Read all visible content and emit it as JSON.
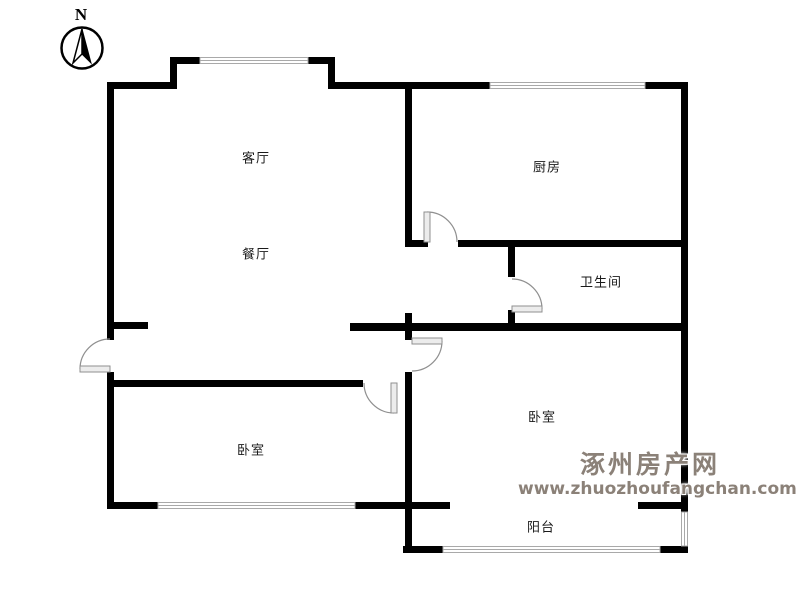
{
  "compass": {
    "label": "N",
    "icon": "north-compass-icon"
  },
  "rooms": [
    {
      "id": "living-room",
      "label": "客厅"
    },
    {
      "id": "dining-room",
      "label": "餐厅"
    },
    {
      "id": "kitchen",
      "label": "厨房"
    },
    {
      "id": "bathroom",
      "label": "卫生间"
    },
    {
      "id": "bedroom-right",
      "label": "卧室"
    },
    {
      "id": "bedroom-left",
      "label": "卧室"
    },
    {
      "id": "balcony",
      "label": "阳台"
    }
  ],
  "watermark": {
    "site_name": "涿州房产网",
    "site_url": "www.zhuozhoufangchan.com"
  },
  "colors": {
    "wall": "#000000",
    "window_frame": "#a9a9a9",
    "door": "#8f8f8f",
    "watermark": "#8b8178",
    "label": "#1a1a1a",
    "background": "#ffffff"
  }
}
